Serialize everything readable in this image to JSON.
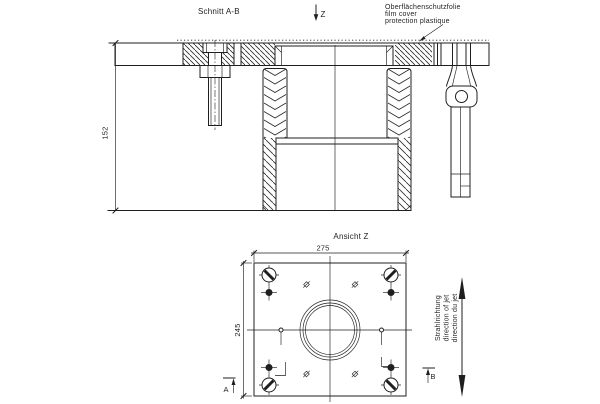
{
  "meta": {
    "background": "#ffffff",
    "line_color": "#1f1f1f",
    "drawing_type": "technical drawing, section and plan view"
  },
  "section_view": {
    "title": "Schnitt A-B",
    "view_arrow_label": "Z",
    "film_note": {
      "line1": "Oberflächenschutzfolie",
      "line2": "film cover",
      "line3": "protection plastique"
    },
    "height_dim": "152"
  },
  "plan_view": {
    "title": "Ansicht Z",
    "width_dim": "275",
    "depth_dim": "245",
    "marker_a": "A",
    "marker_b": "B",
    "jet_note": {
      "line1": "Strahlrichtung",
      "line2": "direction of jet",
      "line3": "direction du jet"
    }
  }
}
